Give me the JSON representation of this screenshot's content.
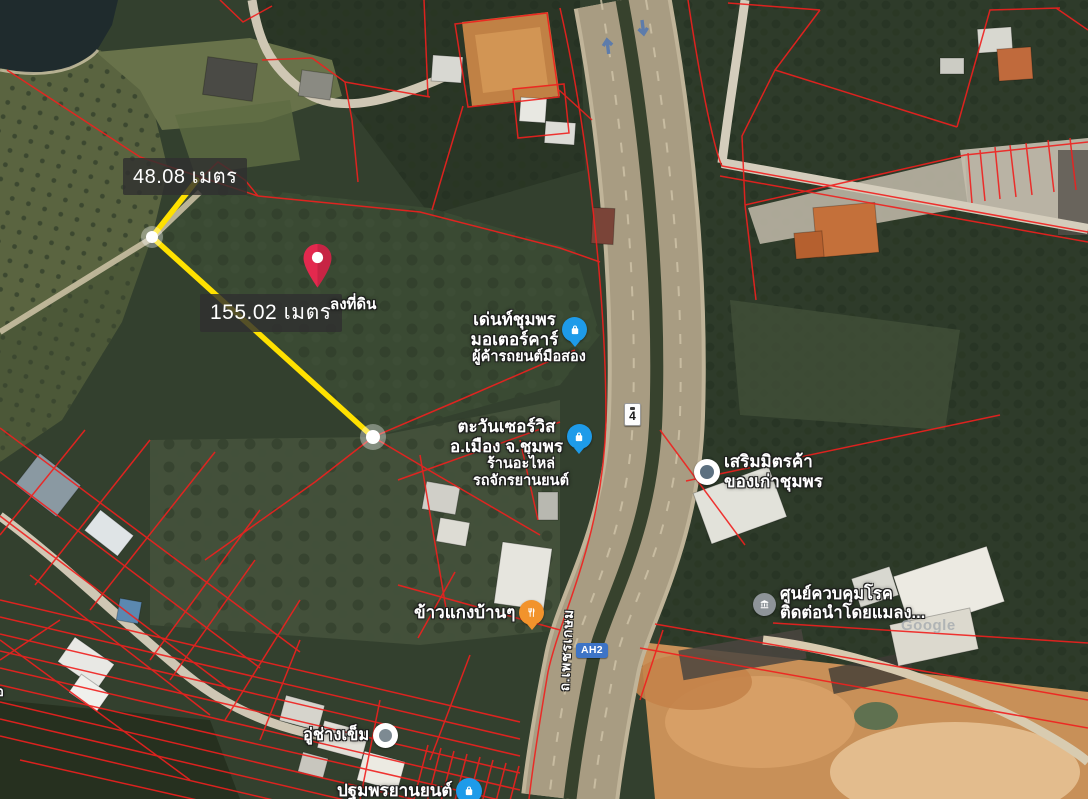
{
  "map": {
    "type": "satellite",
    "watermark": "Google",
    "edge_label": "อ",
    "road": {
      "route_shield": "4",
      "ah_shield": "AH2",
      "name_vertical": "ถ.เพชรเกษม"
    },
    "measurement": {
      "segment1_label": "48.08 เมตร",
      "segment2_label": "155.02 เมตร",
      "line_color": "#FFE100"
    },
    "pin": {
      "label": "ลงที่ดิน",
      "color": "#E3294E"
    },
    "places": [
      {
        "name": "เด่นท์ชุมพร\nมอเตอร์คาร์",
        "subtitle": "ผู้ค้ารถยนต์มือสอง",
        "icon": "shopping-bag-icon",
        "icon_color": "#1E9BE9"
      },
      {
        "name": "ตะวันเซอร์วิส\nอ.เมือง จ.ชุมพร",
        "subtitle": "ร้านอะไหล่\nรถจักรยานยนต์",
        "icon": "shopping-bag-icon",
        "icon_color": "#1E9BE9"
      },
      {
        "name": "เสริมมิตรค้า\nของเก่าชุมพร",
        "subtitle": "",
        "icon": "generic-place-icon",
        "icon_color": "#FFFFFF"
      },
      {
        "name": "ข้าวแกงบ้านๆ",
        "subtitle": "",
        "icon": "restaurant-icon",
        "icon_color": "#F2932C"
      },
      {
        "name": "ศูนย์ควบคุมโรค\nติดต่อนำโดยแมลง...",
        "subtitle": "",
        "icon": "government-icon",
        "icon_color": "#8E9499"
      },
      {
        "name": "อู่ช่างเข็ม",
        "subtitle": "",
        "icon": "generic-place-icon",
        "icon_color": "#FFFFFF"
      },
      {
        "name": "ปฐมพรยานยนต์",
        "subtitle": "",
        "icon": "shopping-bag-icon",
        "icon_color": "#1E9BE9"
      }
    ],
    "overlay": {
      "parcel_line_color": "#F0201E"
    }
  }
}
